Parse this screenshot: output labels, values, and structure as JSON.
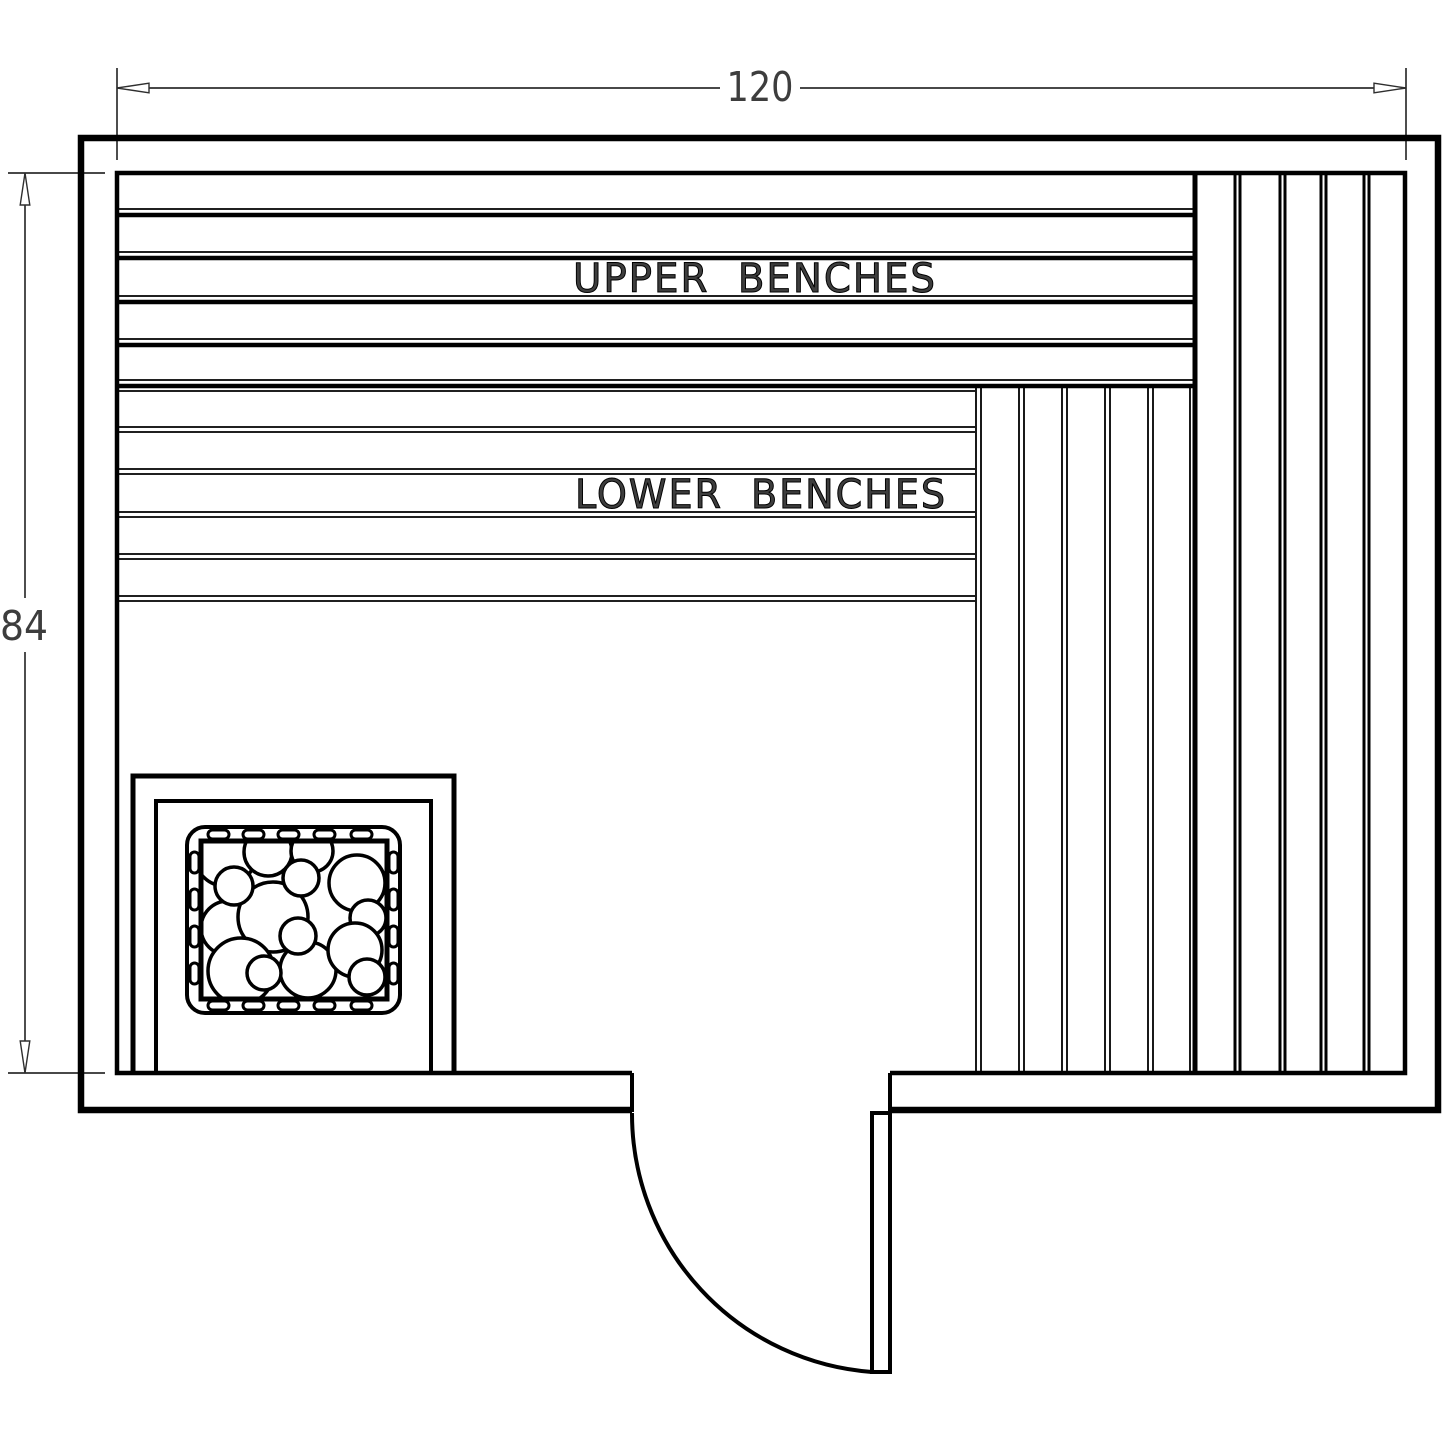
{
  "drawing": {
    "title": "sauna-floor-plan",
    "dimensions": {
      "width_dim": "120",
      "height_dim": "84"
    },
    "labels": {
      "upper_benches": "UPPER  BENCHES",
      "lower_benches": "LOWER  BENCHES"
    },
    "colors": {
      "wall_line": "#000000",
      "dim_line": "#2e2e2e",
      "text": "#3d3d3d",
      "background": "#ffffff"
    }
  }
}
